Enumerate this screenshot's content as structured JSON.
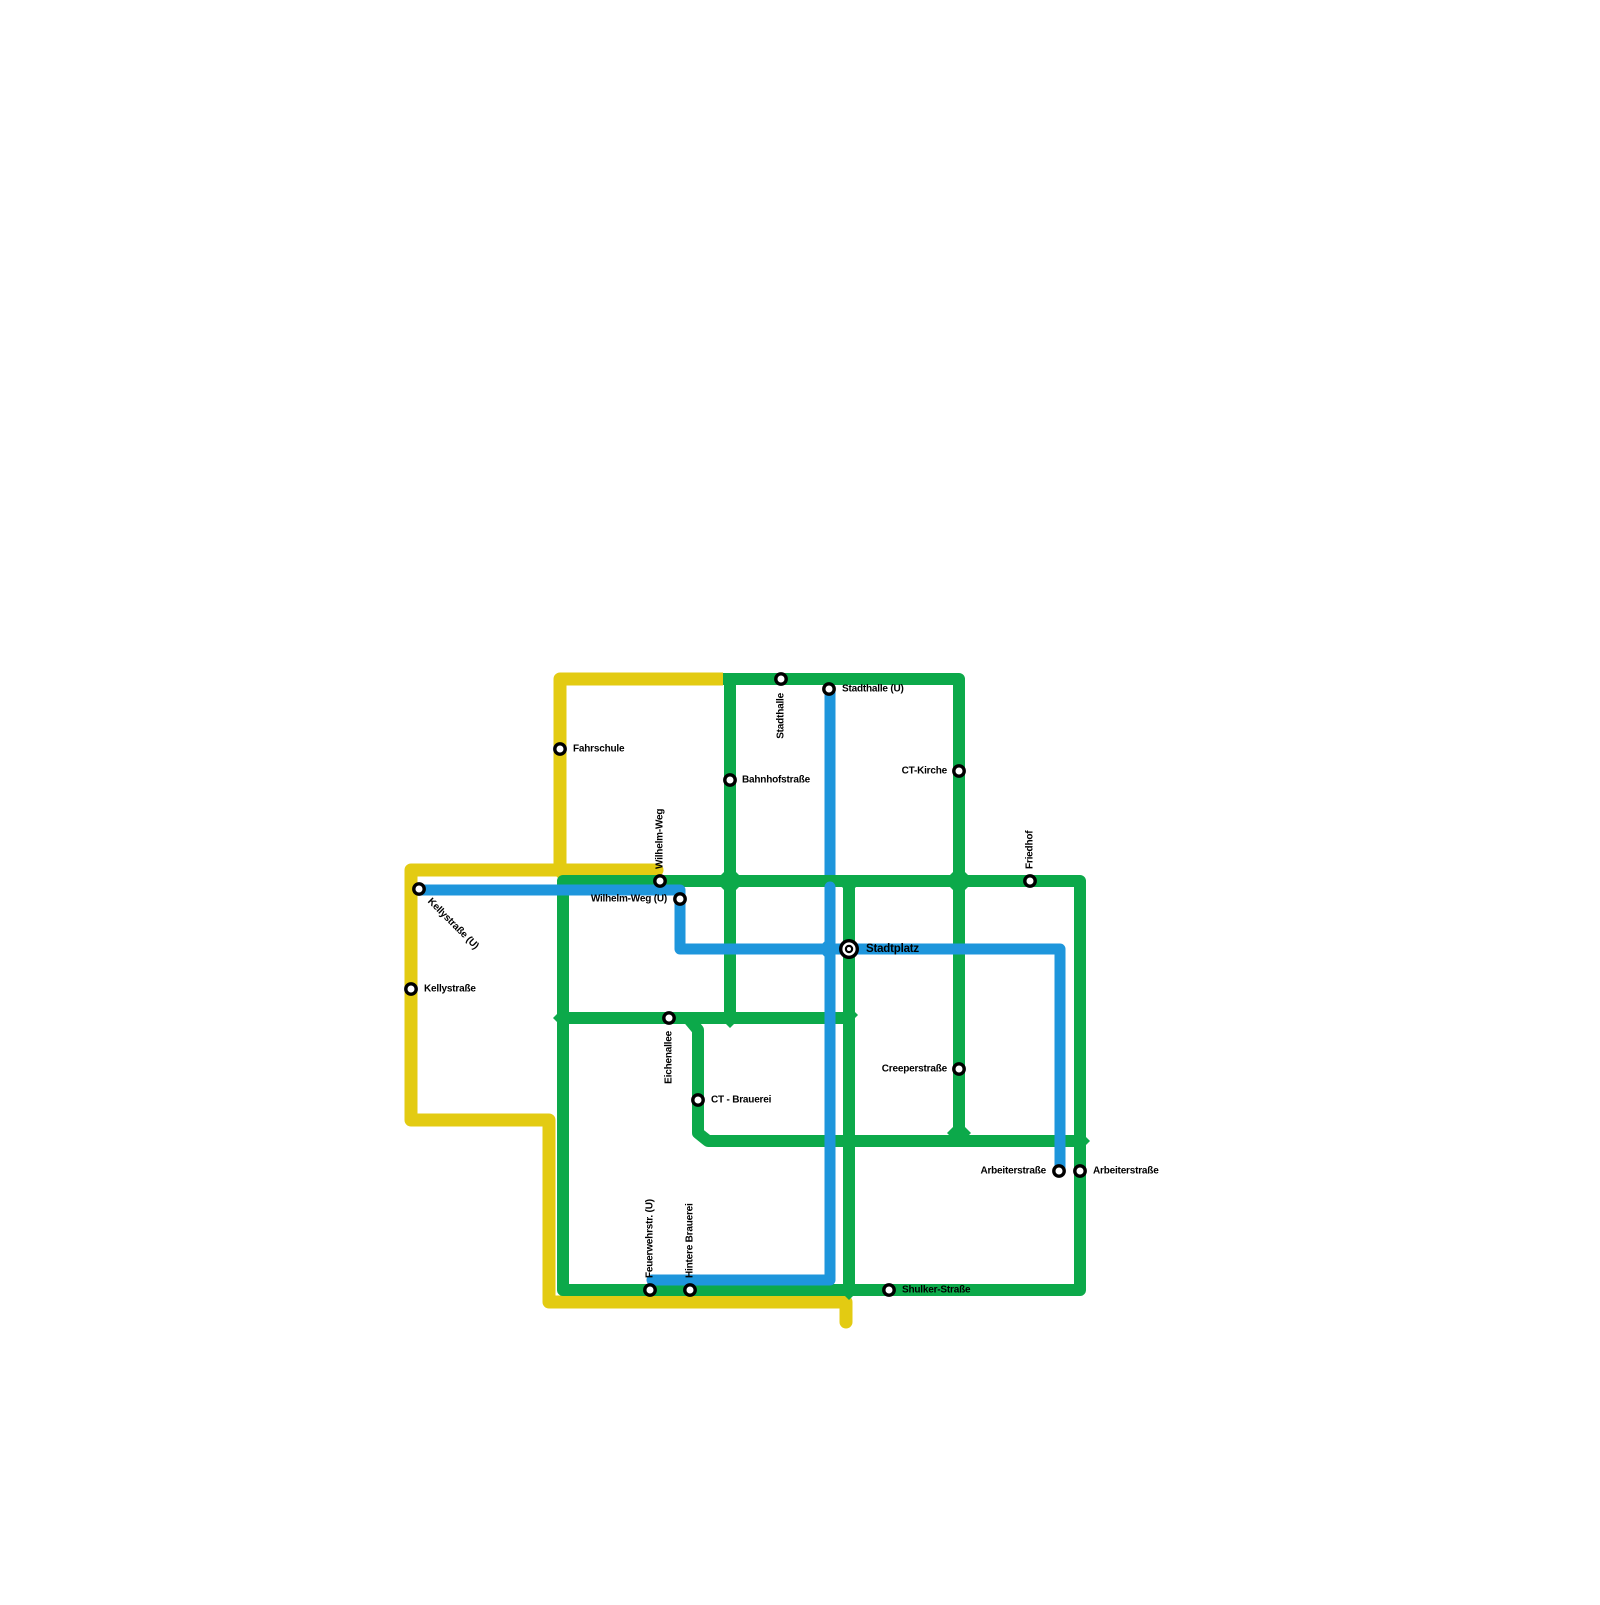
{
  "title": "Transit network map",
  "map": {
    "colors": {
      "yellow": "#E3CB12",
      "green": "#0CA94A",
      "blue": "#1E96DC",
      "label": "#000000",
      "marker_fill": "#ffffff",
      "marker_ring": "#000000",
      "background": "#ffffff"
    },
    "line_widths": {
      "yellow": 13,
      "green": 12,
      "blue": 11
    },
    "layers": [
      {
        "id": "yellow-top-branch",
        "type": "polyline",
        "color": "yellow",
        "cap": "butt",
        "points": [
          [
            723,
            679
          ],
          [
            560,
            679
          ],
          [
            560,
            870
          ]
        ]
      },
      {
        "id": "yellow-main",
        "type": "polyline",
        "color": "yellow",
        "cap": "round",
        "points": [
          [
            657,
            870
          ],
          [
            411,
            870
          ],
          [
            411,
            1120
          ],
          [
            549,
            1120
          ],
          [
            549,
            1302
          ],
          [
            846,
            1302
          ],
          [
            846,
            1322
          ]
        ]
      },
      {
        "id": "yellow-junction-diamond",
        "type": "diamond",
        "color": "yellow",
        "x": 560,
        "y": 870,
        "size": 10
      },
      {
        "id": "blue-stadthalle-upper",
        "type": "polyline",
        "color": "blue",
        "cap": "butt",
        "points": [
          [
            830,
            690
          ],
          [
            830,
            882
          ]
        ]
      },
      {
        "id": "green-loop",
        "type": "polygon",
        "color": "green",
        "cap": "round",
        "points": [
          [
            563,
            881
          ],
          [
            1080,
            881
          ],
          [
            1080,
            1290
          ],
          [
            563,
            1290
          ]
        ]
      },
      {
        "id": "green-top-u",
        "type": "polyline",
        "color": "green",
        "cap": "butt",
        "points": [
          [
            723,
            679
          ],
          [
            959,
            679
          ],
          [
            959,
            1141
          ]
        ]
      },
      {
        "id": "green-bahnhof-vertical",
        "type": "polyline",
        "color": "green",
        "cap": "butt",
        "points": [
          [
            730,
            679
          ],
          [
            730,
            1018
          ]
        ]
      },
      {
        "id": "green-stadtplatz-vertical",
        "type": "polyline",
        "color": "green",
        "cap": "butt",
        "points": [
          [
            849,
            881
          ],
          [
            849,
            1290
          ]
        ]
      },
      {
        "id": "green-eichenallee-horizontal",
        "type": "polyline",
        "color": "green",
        "cap": "butt",
        "points": [
          [
            563,
            1018
          ],
          [
            849,
            1018
          ]
        ]
      },
      {
        "id": "green-brauerei-branch",
        "type": "polyline",
        "color": "green",
        "cap": "butt",
        "points": [
          [
            688,
            1018
          ],
          [
            698,
            1030
          ],
          [
            698,
            1133
          ],
          [
            708,
            1141
          ],
          [
            1080,
            1141
          ]
        ]
      },
      {
        "id": "green-diamond-wilhelmweg-x",
        "type": "diamond",
        "color": "green",
        "x": 730,
        "y": 881,
        "size": 15
      },
      {
        "id": "green-diamond-friedhof-x",
        "type": "diamond",
        "color": "green",
        "x": 959,
        "y": 881,
        "size": 15
      },
      {
        "id": "green-diamond-stadtplatz-top",
        "type": "diamond",
        "color": "green",
        "x": 849,
        "y": 886,
        "size": 8
      },
      {
        "id": "green-diamond-eichenallee-left",
        "type": "diamond",
        "color": "green",
        "x": 563,
        "y": 1018,
        "size": 10
      },
      {
        "id": "green-diamond-eichenallee-mid",
        "type": "diamond",
        "color": "green",
        "x": 730,
        "y": 1018,
        "size": 10
      },
      {
        "id": "green-diamond-eichenallee-right",
        "type": "diamond",
        "color": "green",
        "x": 849,
        "y": 1015,
        "size": 9
      },
      {
        "id": "green-diamond-south-cross-1",
        "type": "diamond",
        "color": "green",
        "x": 849,
        "y": 1141,
        "size": 11
      },
      {
        "id": "green-diamond-south-merge",
        "type": "diamond",
        "color": "green",
        "x": 959,
        "y": 1133,
        "size": 12
      },
      {
        "id": "green-diamond-south-cross-2",
        "type": "diamond",
        "color": "green",
        "x": 1080,
        "y": 1141,
        "size": 10
      },
      {
        "id": "green-diamond-bottom",
        "type": "diamond",
        "color": "green",
        "x": 849,
        "y": 1290,
        "size": 10
      },
      {
        "id": "blue-kelly-arbeiter",
        "type": "polyline",
        "color": "blue",
        "cap": "round",
        "points": [
          [
            419,
            890
          ],
          [
            680,
            890
          ],
          [
            680,
            949
          ],
          [
            1060,
            949
          ],
          [
            1060,
            1171
          ]
        ]
      },
      {
        "id": "blue-stadthalle-lower",
        "type": "polyline",
        "color": "blue",
        "cap": "round",
        "points": [
          [
            830,
            887
          ],
          [
            830,
            1280
          ],
          [
            652,
            1280
          ]
        ]
      },
      {
        "id": "blue-diamond-stadtplatz",
        "type": "diamond",
        "color": "blue",
        "x": 828,
        "y": 949,
        "size": 11
      }
    ],
    "stations": [
      {
        "id": "fahrschule",
        "x": 560,
        "y": 749,
        "marker": "dot",
        "label": "Fahrschule",
        "label_x": 573,
        "label_y": 749,
        "anchor": "start",
        "rotate": 0
      },
      {
        "id": "kellystrasse-u",
        "x": 419,
        "y": 889,
        "marker": "dot",
        "label": "Kellystraße (U)",
        "label_x": 429,
        "label_y": 900,
        "anchor": "start",
        "rotate": 45
      },
      {
        "id": "kellystrasse",
        "x": 411,
        "y": 989,
        "marker": "dot",
        "label": "Kellystraße",
        "label_x": 424,
        "label_y": 989,
        "anchor": "start",
        "rotate": 0
      },
      {
        "id": "stadthalle",
        "x": 781,
        "y": 679,
        "marker": "dot",
        "label": "Stadthalle",
        "label_x": 781,
        "label_y": 693,
        "anchor": "end",
        "rotate": -90
      },
      {
        "id": "stadthalle-u",
        "x": 829,
        "y": 689,
        "marker": "dot",
        "label": "Stadthalle (U)",
        "label_x": 842,
        "label_y": 689,
        "anchor": "start",
        "rotate": 0
      },
      {
        "id": "bahnhofstrasse",
        "x": 730,
        "y": 780,
        "marker": "dot",
        "label": "Bahnhofstraße",
        "label_x": 742,
        "label_y": 780,
        "anchor": "start",
        "rotate": 0
      },
      {
        "id": "ct-kirche",
        "x": 959,
        "y": 771,
        "marker": "dot",
        "label": "CT-Kirche",
        "label_x": 947,
        "label_y": 771,
        "anchor": "end",
        "rotate": 0
      },
      {
        "id": "friedhof",
        "x": 1030,
        "y": 881,
        "marker": "dot",
        "label": "Friedhof",
        "label_x": 1030,
        "label_y": 869,
        "anchor": "start",
        "rotate": -90
      },
      {
        "id": "wilhelm-weg",
        "x": 660,
        "y": 881,
        "marker": "dot",
        "label": "Wilhelm-Weg",
        "label_x": 660,
        "label_y": 869,
        "anchor": "start",
        "rotate": -90
      },
      {
        "id": "wilhelm-weg-u",
        "x": 680,
        "y": 899,
        "marker": "dot",
        "label": "Wilhelm-Weg (U)",
        "label_x": 667,
        "label_y": 899,
        "anchor": "end",
        "rotate": 0
      },
      {
        "id": "stadtplatz",
        "x": 849,
        "y": 949,
        "marker": "interchange",
        "label": "Stadtplatz",
        "label_x": 866,
        "label_y": 949,
        "anchor": "start",
        "rotate": 0,
        "big": true
      },
      {
        "id": "eichenallee",
        "x": 669,
        "y": 1018,
        "marker": "dot",
        "label": "Eichenallee",
        "label_x": 669,
        "label_y": 1031,
        "anchor": "end",
        "rotate": -90
      },
      {
        "id": "ct-brauerei",
        "x": 698,
        "y": 1100,
        "marker": "dot",
        "label": "CT - Brauerei",
        "label_x": 711,
        "label_y": 1100,
        "anchor": "start",
        "rotate": 0
      },
      {
        "id": "creeperstrasse",
        "x": 959,
        "y": 1069,
        "marker": "dot",
        "label": "Creeperstraße",
        "label_x": 947,
        "label_y": 1069,
        "anchor": "end",
        "rotate": 0
      },
      {
        "id": "arbeiterstrasse-u",
        "x": 1059,
        "y": 1171,
        "marker": "dot",
        "label": "Arbeiterstraße",
        "label_x": 1046,
        "label_y": 1171,
        "anchor": "end",
        "rotate": 0
      },
      {
        "id": "arbeiterstrasse",
        "x": 1080,
        "y": 1171,
        "marker": "dot",
        "label": "Arbeiterstraße",
        "label_x": 1093,
        "label_y": 1171,
        "anchor": "start",
        "rotate": 0
      },
      {
        "id": "feuerwehrstr-u",
        "x": 650,
        "y": 1290,
        "marker": "dot",
        "label": "Feuerwehrstr. (U)",
        "label_x": 650,
        "label_y": 1278,
        "anchor": "start",
        "rotate": -90
      },
      {
        "id": "hintere-brauerei",
        "x": 690,
        "y": 1290,
        "marker": "dot",
        "label": "Hintere Brauerei",
        "label_x": 690,
        "label_y": 1278,
        "anchor": "start",
        "rotate": -90
      },
      {
        "id": "shulker-strasse",
        "x": 889,
        "y": 1290,
        "marker": "dot",
        "label": "Shulker-Straße",
        "label_x": 902,
        "label_y": 1290,
        "anchor": "start",
        "rotate": 0
      }
    ]
  }
}
